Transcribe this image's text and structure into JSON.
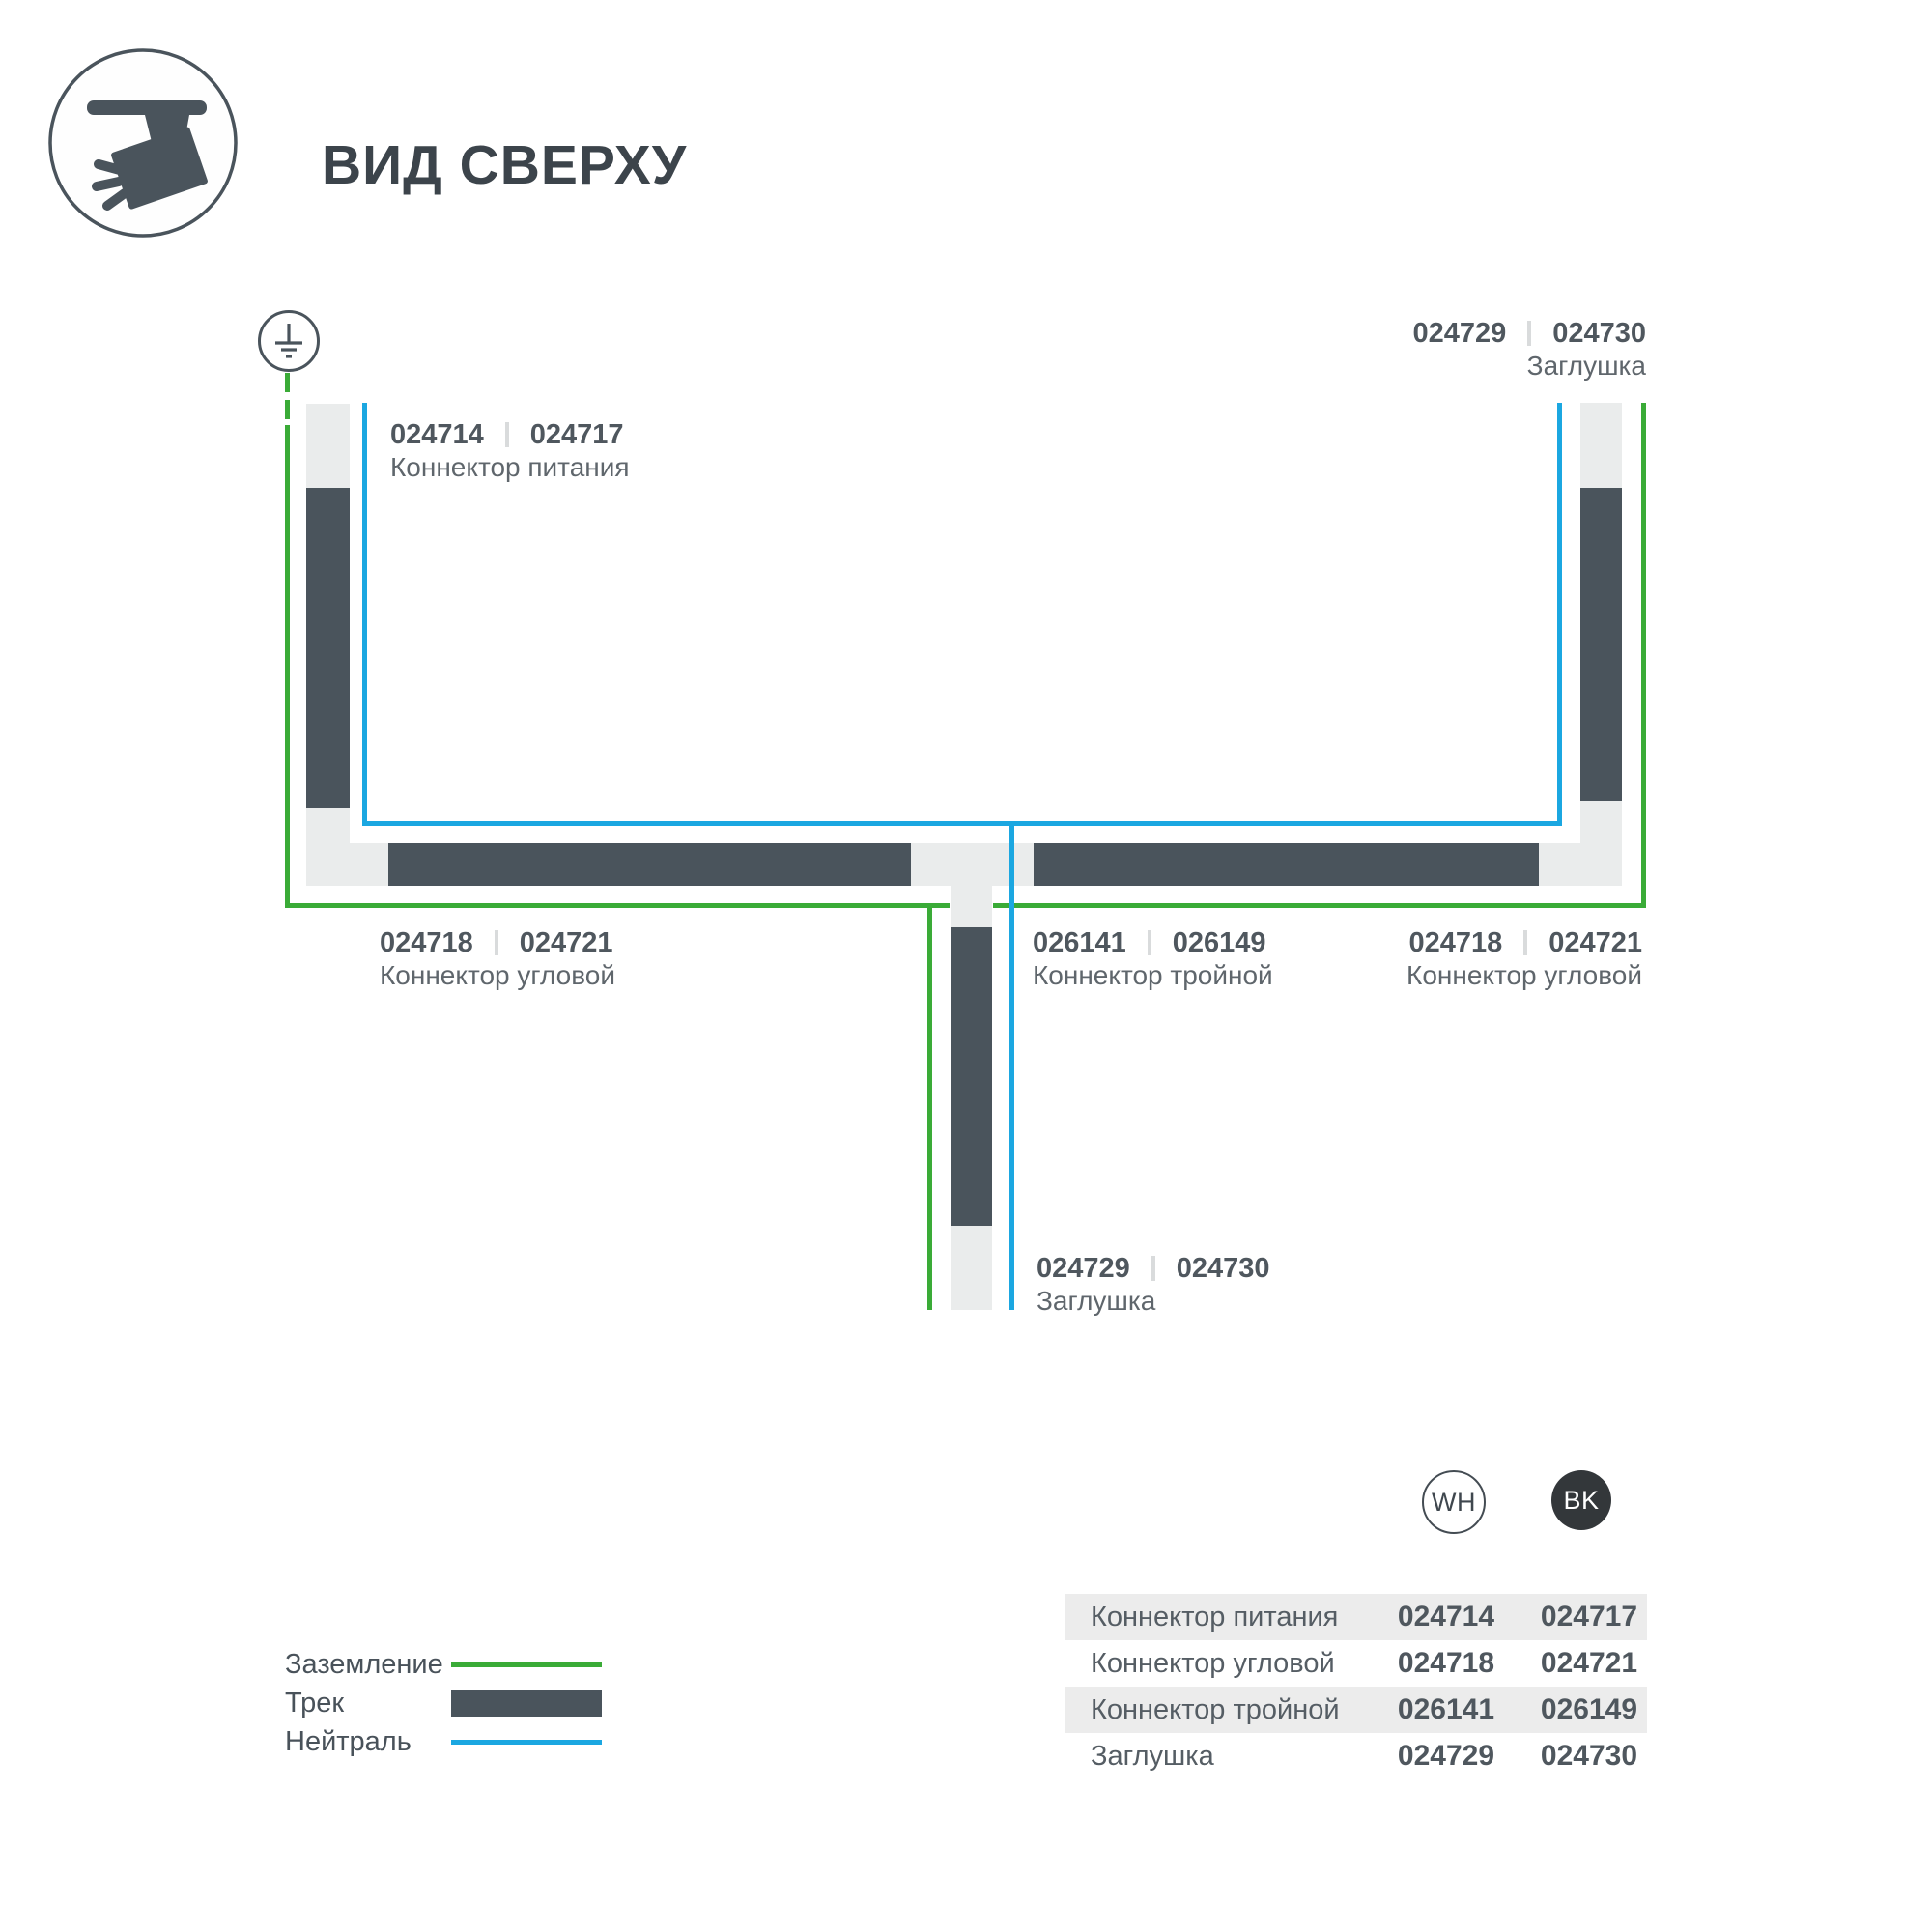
{
  "colors": {
    "green": "#3aab37",
    "blue": "#1ba7e1",
    "track_dark": "#4a545c",
    "track_light": "#eaecec",
    "text_title": "#3c444b",
    "text_num": "#4f575e",
    "text_name": "#5f666c",
    "divider": "#d9dbdc",
    "row_alt": "#ececec",
    "bk_fill": "#33373a"
  },
  "header": {
    "title": "ВИД СВЕРХУ",
    "icon": "track-light-icon"
  },
  "diagram": {
    "ground_icon": "earth-ground-icon",
    "legend_lines": {
      "ground": "Заземление",
      "track": "Трек",
      "neutral": "Нейтраль"
    },
    "labels": {
      "power": {
        "num1": "024714",
        "num2": "024717",
        "name": "Коннектор питания"
      },
      "cap_top": {
        "num1": "024729",
        "num2": "024730",
        "name": "Заглушка"
      },
      "corner_left": {
        "num1": "024718",
        "num2": "024721",
        "name": "Коннектор угловой"
      },
      "triple": {
        "num1": "026141",
        "num2": "026149",
        "name": "Коннектор тройной"
      },
      "corner_right": {
        "num1": "024718",
        "num2": "024721",
        "name": "Коннектор угловой"
      },
      "cap_bottom": {
        "num1": "024729",
        "num2": "024730",
        "name": "Заглушка"
      }
    }
  },
  "legend": {
    "items": [
      {
        "label": "Заземление",
        "swatch": "green-line"
      },
      {
        "label": "Трек",
        "swatch": "track-bar"
      },
      {
        "label": "Нейтраль",
        "swatch": "blue-line"
      }
    ]
  },
  "variants": {
    "wh": "WH",
    "bk": "BK"
  },
  "table": {
    "rows": [
      {
        "name": "Коннектор питания",
        "wh": "024714",
        "bk": "024717"
      },
      {
        "name": "Коннектор угловой",
        "wh": "024718",
        "bk": "024721"
      },
      {
        "name": "Коннектор тройной",
        "wh": "026141",
        "bk": "026149"
      },
      {
        "name": "Заглушка",
        "wh": "024729",
        "bk": "024730"
      }
    ]
  }
}
